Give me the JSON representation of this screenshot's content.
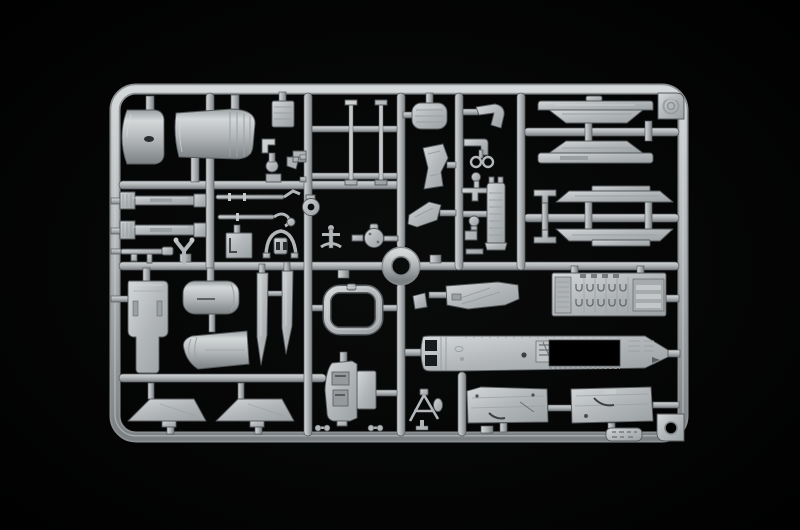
{
  "scene": {
    "description": "Product photograph of a light grey injection-moulded plastic model kit sprue (parts runner frame) containing aircraft model parts, shot on a pure black background",
    "photo_type": "model-kit-sprue",
    "visible_text": "none (only an illegible embossed mould tag and embossed maker logo)",
    "palette": {
      "background": "#000000",
      "base": "#b2b6b8",
      "highlight": "#d3d7d8",
      "mid": "#9aa0a2",
      "shadow": "#7b8083",
      "outline": "#565a5d",
      "recess": "#2a2d2f"
    },
    "frame": {
      "shape": "rounded rectangle runner frame",
      "center_feature": "circular runner ring",
      "corner_features": [
        "embossed logo tab top-right",
        "locating-hole tab bottom-right",
        "illegible embossed mould tag on bottom rail"
      ]
    },
    "parts": [
      {
        "id": "exhaust-cone-half",
        "desc": "tapered exhaust cone half, top-left"
      },
      {
        "id": "rear-fuselage-shell",
        "desc": "large rear fuselage shell with ribbed collar"
      },
      {
        "id": "avionics-box",
        "desc": "small ribbed avionics box"
      },
      {
        "id": "fitting-cluster",
        "desc": "cluster of small elbow, lamp, wedge and bracket fittings"
      },
      {
        "id": "gear-door-struts",
        "desc": "pair of long thin struts"
      },
      {
        "id": "seat-cushion",
        "desc": "ribbed seat cushion pad"
      },
      {
        "id": "ejection-seat-half",
        "desc": "ejection seat side half"
      },
      {
        "id": "seat-frame",
        "desc": "angular seat frame"
      },
      {
        "id": "fork-clevis",
        "desc": "forked clevis fitting"
      },
      {
        "id": "elbow-pipe",
        "desc": "L-shaped pipe"
      },
      {
        "id": "twin-ring",
        "desc": "twin-ring fitting"
      },
      {
        "id": "small-fittings-column",
        "desc": "column of small caps, boxes and fittings"
      },
      {
        "id": "launcher-tower",
        "desc": "tall ribbed launcher half with pronged top"
      },
      {
        "id": "pylon-half-upper",
        "desc": "elongated pylon/tank half, upper"
      },
      {
        "id": "pylon-half-lower",
        "desc": "elongated pylon/tank half, lower (mirrored)"
      },
      {
        "id": "rail-upper",
        "desc": "missile rail half with flared ends, upper"
      },
      {
        "id": "rail-lower",
        "desc": "missile rail half with flared ends, lower"
      },
      {
        "id": "h-bracket",
        "desc": "H-shaped clamp bracket"
      },
      {
        "id": "ribbed-rail-assembly",
        "desc": "two parallel jet-pipe rails with ribbed ends"
      },
      {
        "id": "y-link",
        "desc": "Y-shaped link"
      },
      {
        "id": "gun-barrel",
        "desc": "gun barrel with muzzle block"
      },
      {
        "id": "pitot-rod",
        "desc": "long rod with bent tip"
      },
      {
        "id": "linkage-rod",
        "desc": "linkage rod with hook and knob"
      },
      {
        "id": "access-panel",
        "desc": "small square access panel"
      },
      {
        "id": "helmet-bracket",
        "desc": "horned bracket with slotted body"
      },
      {
        "id": "wheel-ring",
        "desc": "ring part with centre hole"
      },
      {
        "id": "anchor-link",
        "desc": "anchor-shaped link"
      },
      {
        "id": "valve-body",
        "desc": "round valve body with side pipes"
      },
      {
        "id": "runner-ring",
        "desc": "circular runner ring at sprue centre"
      },
      {
        "id": "door-panel",
        "desc": "long access door panel with slot details"
      },
      {
        "id": "fuselage-barrel-section",
        "desc": "short rounded fuselage barrel section"
      },
      {
        "id": "tail-cone-section",
        "desc": "tapered tail cone section with pleats"
      },
      {
        "id": "fin-blade-a",
        "desc": "long pointed fin blade"
      },
      {
        "id": "fin-blade-b",
        "desc": "long pointed fin blade (shorter)"
      },
      {
        "id": "windscreen-frame",
        "desc": "open windscreen frame loop"
      },
      {
        "id": "cockpit-console",
        "desc": "cockpit side console with recessed panels"
      },
      {
        "id": "tailplane-a",
        "desc": "trapezoidal tailplane"
      },
      {
        "id": "tailplane-b",
        "desc": "trapezoidal tailplane"
      },
      {
        "id": "cockpit-floor",
        "desc": "cockpit floor panel with diagonal lines"
      },
      {
        "id": "equipment-bay",
        "desc": "electronics bay with rows of U-shaped cable details and slatted end"
      },
      {
        "id": "fuselage-half",
        "desc": "main fuselage half with dark bay cutout and intake openings"
      },
      {
        "id": "wing-panel-a",
        "desc": "wing / gear-bay panel with dark hook detail"
      },
      {
        "id": "wing-panel-b",
        "desc": "wing / gear-bay panel with dark hook detail"
      },
      {
        "id": "antenna-frame",
        "desc": "A-frame antenna with small disc"
      },
      {
        "id": "small-dumbbells",
        "desc": "tiny dumbbell fittings near bottom rail"
      },
      {
        "id": "logo-tab",
        "desc": "corner tab with embossed circular maker logo"
      },
      {
        "id": "hole-tab",
        "desc": "corner tab with locating hole"
      },
      {
        "id": "mold-tag",
        "desc": "embossed mould number tag (illegible)"
      }
    ]
  }
}
